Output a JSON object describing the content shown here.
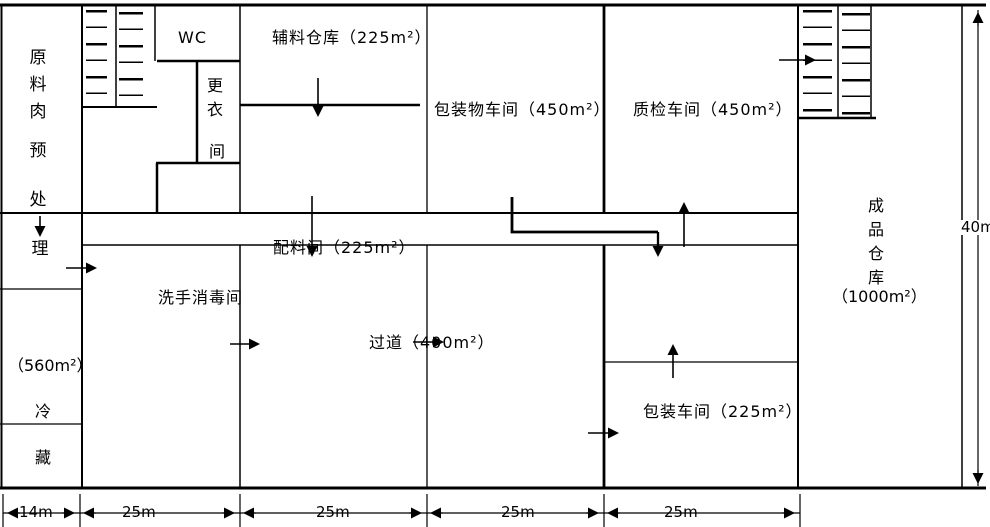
{
  "colors": {
    "ink": "#000000",
    "paper": "#ffffff"
  },
  "rooms": {
    "raw_meat_pretreatment": {
      "name_part1": "原料肉",
      "name_part2": "预处",
      "name_part3": "理"
    },
    "cold_storage": {
      "area": "（560m²）",
      "name_char1": "冷",
      "name_char2": "藏"
    },
    "toilet": {
      "label": "WC"
    },
    "changing_room": {
      "name_part1": "更衣",
      "name_part2": "间"
    },
    "aux_material_warehouse": {
      "label": "辅料仓库（225m²）"
    },
    "packaging_material_workshop": {
      "label": "包装物车间（450m²）"
    },
    "quality_inspection_workshop": {
      "label": "质检车间（450m²）"
    },
    "ingredient_room": {
      "label": "配料间（225m²）"
    },
    "hand_washing_disinfection_room": {
      "label": "洗手消毒间"
    },
    "aisle": {
      "label": "过道（400m²）"
    },
    "packing_workshop": {
      "label": "包装车间（225m²）"
    },
    "finished_goods_warehouse": {
      "name_vertical": "成品仓库",
      "area": "（1000m²）"
    }
  },
  "dimensions": {
    "bottom": [
      "14m",
      "25m",
      "25m",
      "25m",
      "25m"
    ],
    "right": "40m"
  }
}
